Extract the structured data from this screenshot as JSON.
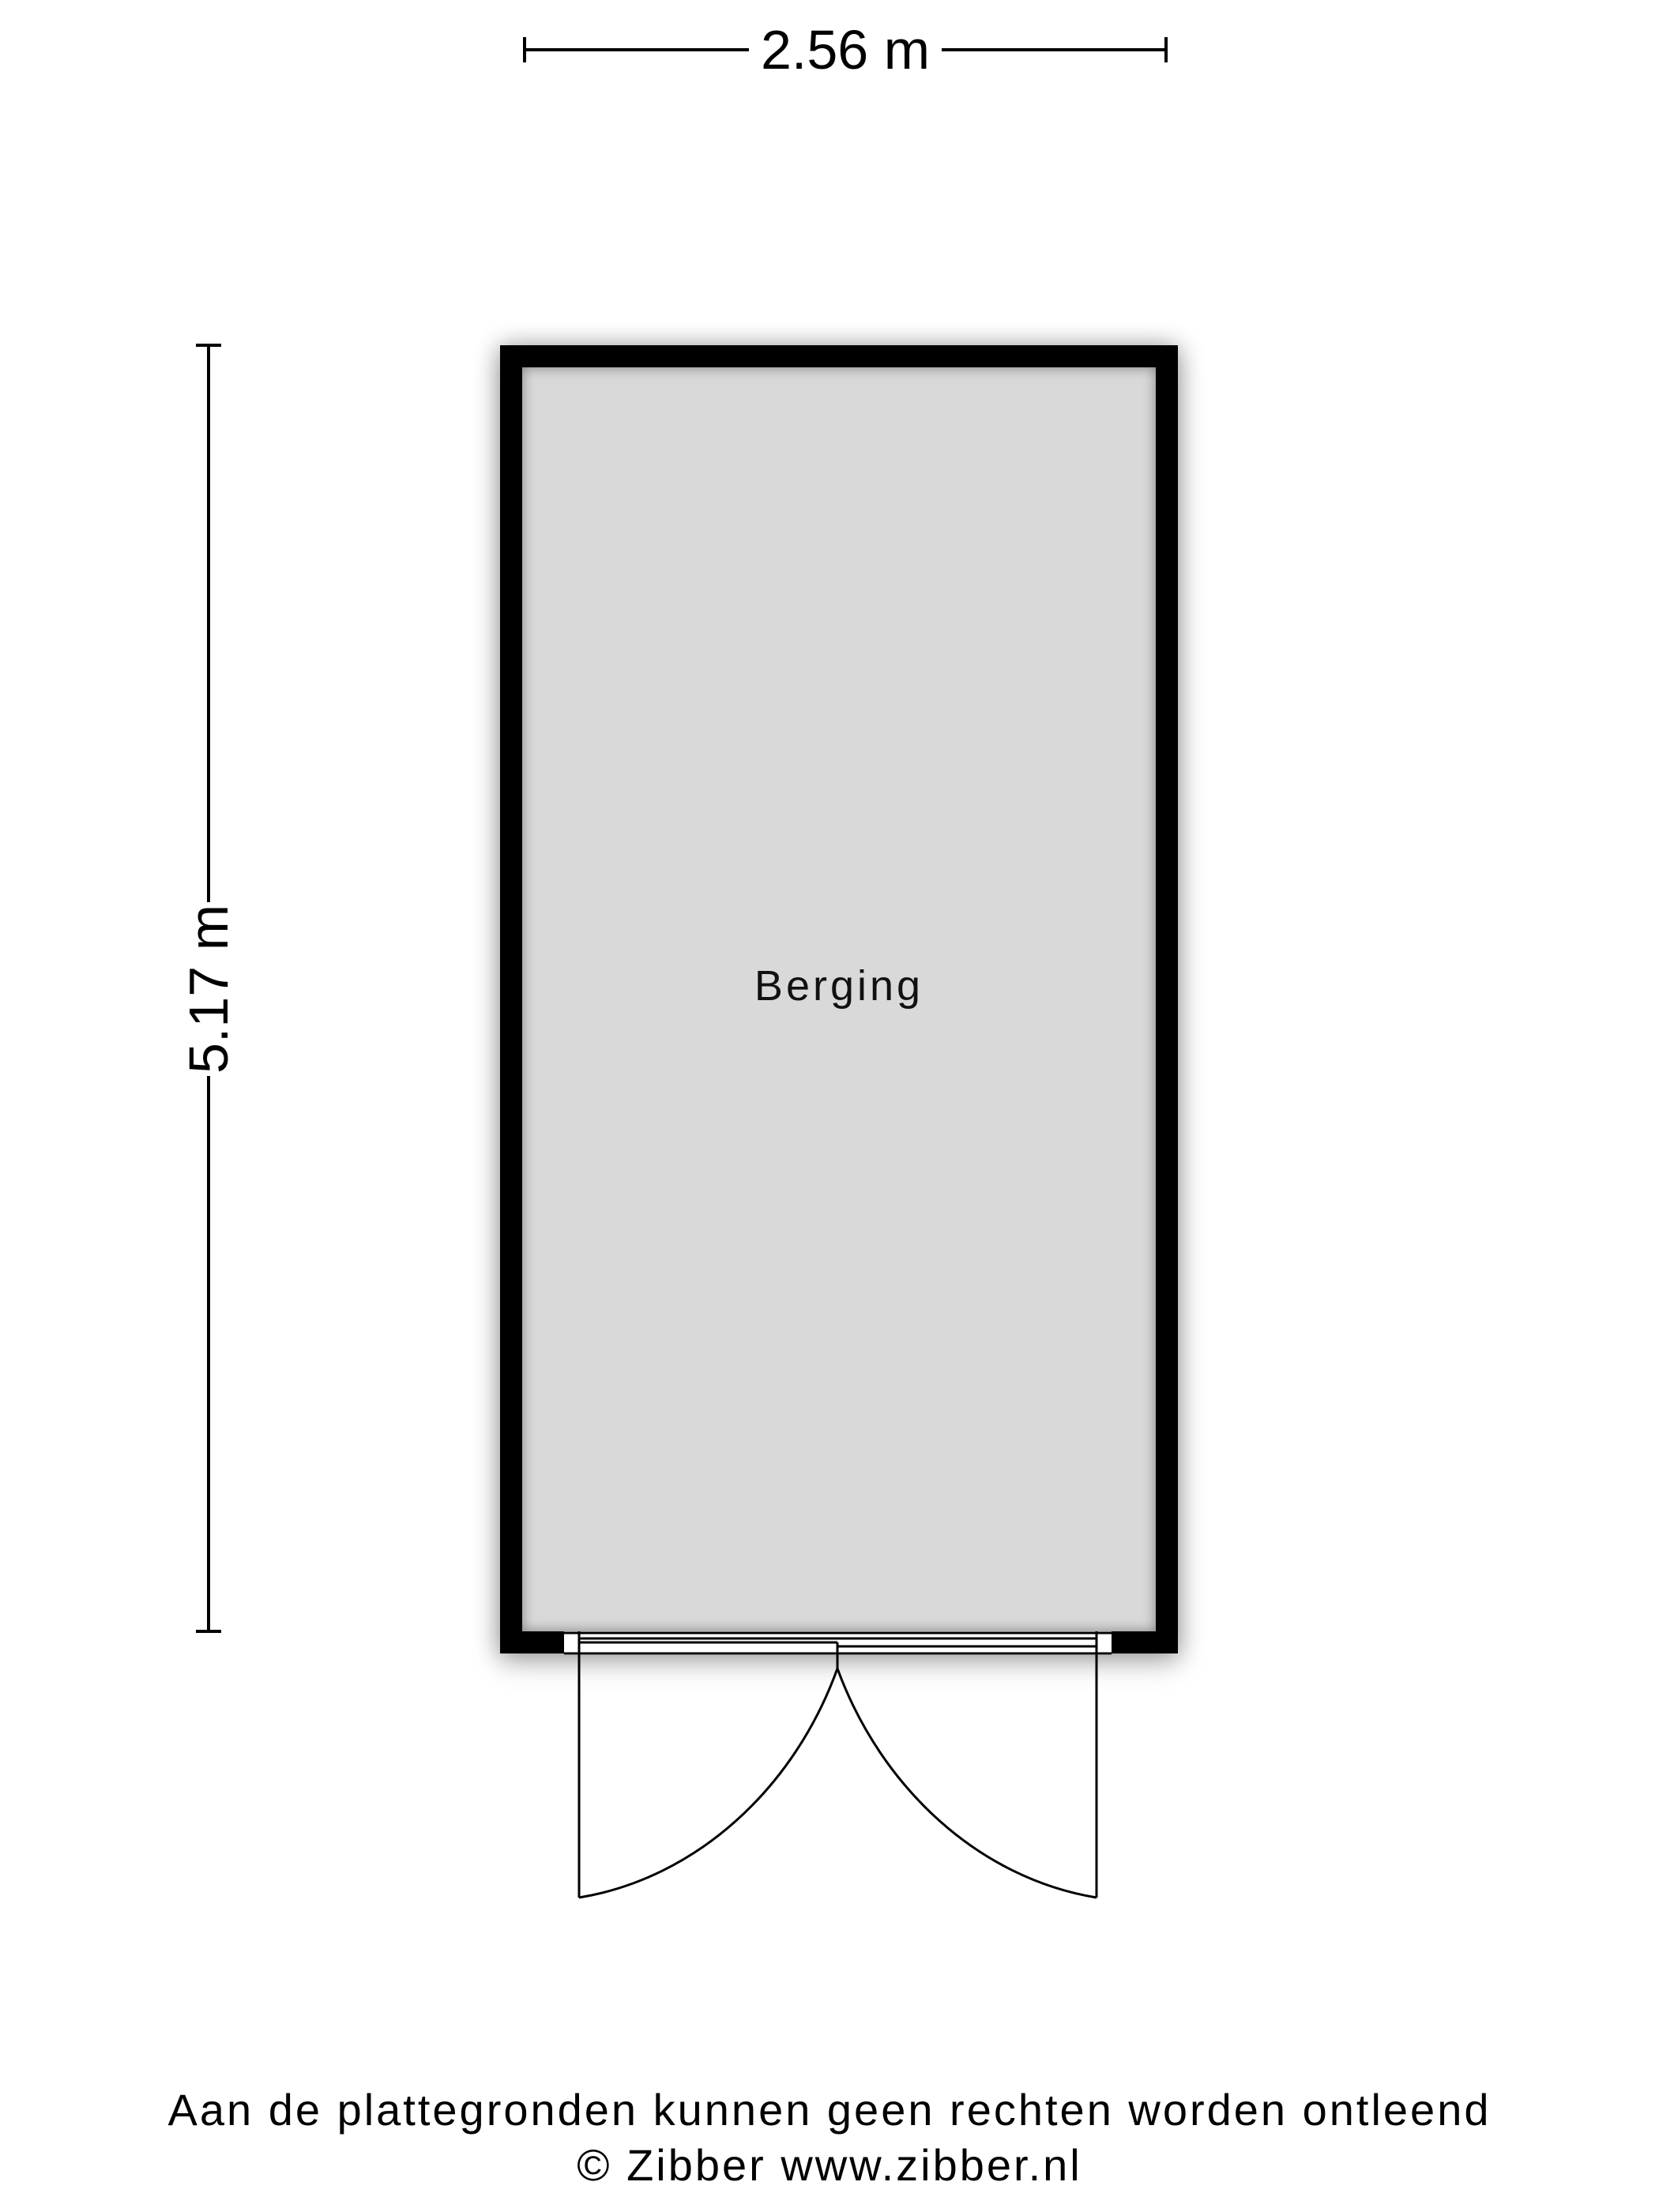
{
  "plan": {
    "room": {
      "label": "Berging",
      "floor_color": "#d9d9d9",
      "wall_color": "#000000"
    },
    "dimensions": {
      "width_label": "2.56 m",
      "height_label": "5.17 m"
    },
    "door": {
      "type": "double-swing-outward"
    }
  },
  "footer": {
    "disclaimer": "Aan de plattegronden kunnen geen rechten worden ontleend",
    "copyright": "© Zibber www.zibber.nl"
  },
  "colors": {
    "background": "#ffffff",
    "line": "#000000"
  }
}
